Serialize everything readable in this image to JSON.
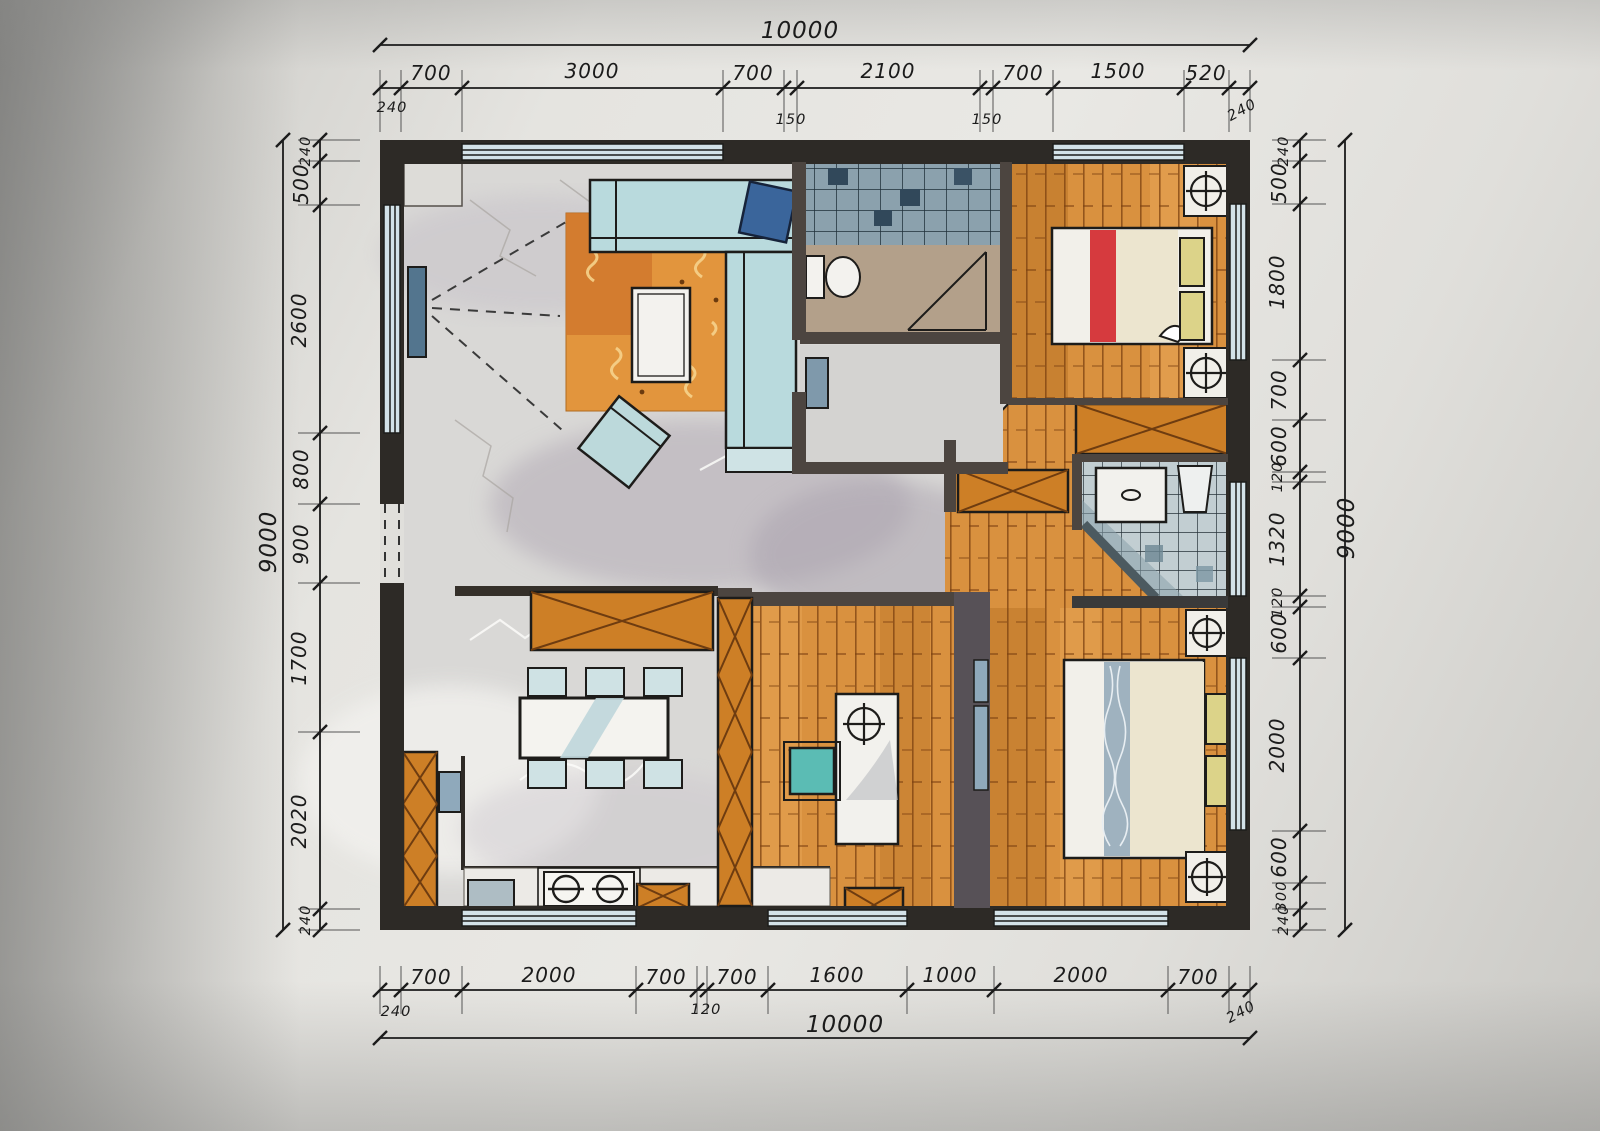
{
  "drawing": {
    "kind": "hand-drawn marker floor plan",
    "units": "mm"
  },
  "dims": {
    "top": {
      "overall": "10000",
      "segments": [
        "240",
        "700",
        "3000",
        "700",
        "150",
        "2100",
        "150",
        "700",
        "1500",
        "520",
        "240"
      ]
    },
    "bottom": {
      "overall": "10000",
      "segments": [
        "240",
        "700",
        "2000",
        "700",
        "120",
        "700",
        "1600",
        "1000",
        "2000",
        "700",
        "240"
      ]
    },
    "left": {
      "overall": "9000",
      "segments": [
        "240",
        "500",
        "2600",
        "800",
        "900",
        "1700",
        "2020",
        "240"
      ]
    },
    "right": {
      "overall": "9000",
      "segments": [
        "240",
        "500",
        "1800",
        "700",
        "600",
        "120",
        "1320",
        "120",
        "600",
        "2000",
        "600",
        "300",
        "240"
      ]
    }
  },
  "palette": {
    "ink": "#1d1c1a",
    "wall": "#2d2a26",
    "wood": "#d9913f",
    "cabinet": "#cd7f26",
    "rug": "#e2953d",
    "sofa": "#b9dadd",
    "tile-dark": "#8ba1ad",
    "tile-light": "#c2ced2",
    "accent-red": "#d63a3e",
    "accent-yellow": "#dcd389",
    "paper": "#e9e8e4"
  }
}
